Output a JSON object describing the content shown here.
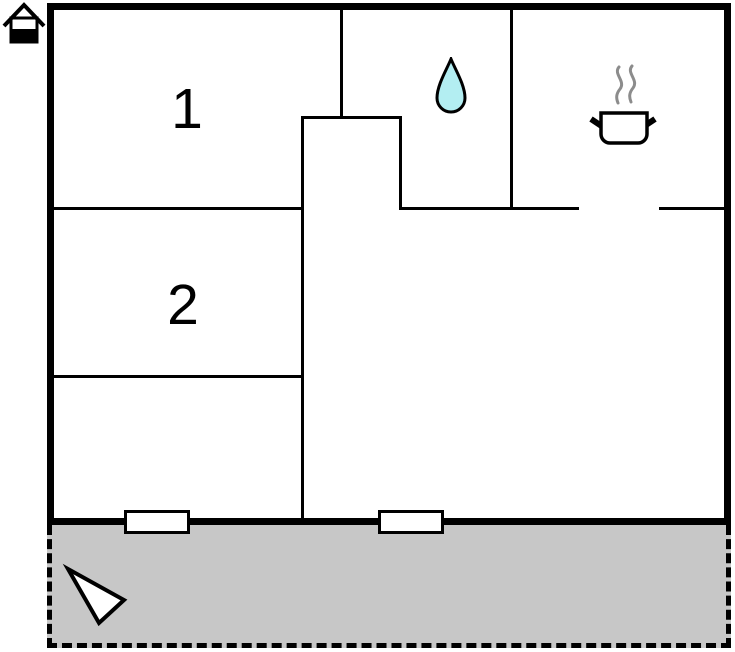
{
  "floorplan": {
    "room_labels": {
      "room1": "1",
      "room2": "2"
    },
    "icons": [
      "house-icon",
      "water-drop-icon",
      "cooking-pot-icon",
      "north-arrow-icon"
    ],
    "windows_count": 2,
    "colors": {
      "wall": "#000000",
      "background": "#ffffff",
      "water_drop_fill": "#b3eef2",
      "terrace_fill": "#c7c7c7",
      "steam": "#8c8c8c",
      "window_fill": "#ffffff"
    }
  }
}
